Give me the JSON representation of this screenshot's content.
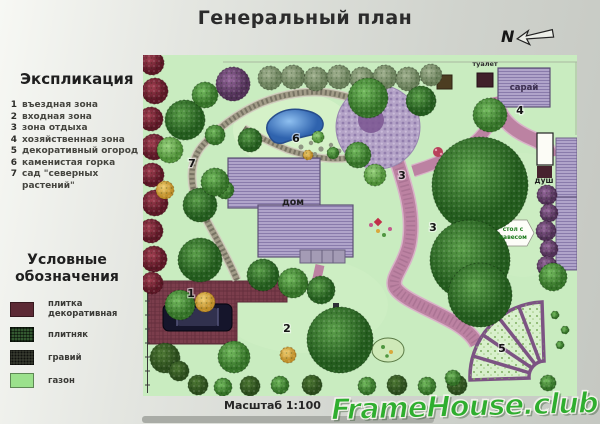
{
  "title": "Генеральный план",
  "compass": {
    "label": "N"
  },
  "explication": {
    "heading": "Экспликация",
    "items": [
      {
        "num": "1",
        "label": "въездная зона"
      },
      {
        "num": "2",
        "label": "входная зона"
      },
      {
        "num": "3",
        "label": "зона отдыха"
      },
      {
        "num": "4",
        "label": "хозяйственная зона"
      },
      {
        "num": "5",
        "label": "декоративный огород"
      },
      {
        "num": "6",
        "label": "каменистая горка"
      },
      {
        "num": "7",
        "label": "сад \"северных растений\""
      }
    ]
  },
  "legend": {
    "heading": "Условные обозначения",
    "items": [
      {
        "label": "плитка декоративная",
        "color": "#5d2a35"
      },
      {
        "label": "плитняк",
        "color": "#335830"
      },
      {
        "label": "гравий",
        "color": "#3c4034"
      },
      {
        "label": "газон",
        "color": "#9be18c"
      }
    ]
  },
  "plan": {
    "labels": {
      "house": "дом",
      "shed": "сарай",
      "toilet": "туалет",
      "shower": "душ",
      "table_line1": "стол с",
      "table_line2": "навесом"
    },
    "markers": [
      "1",
      "2",
      "3",
      "3",
      "4",
      "5",
      "6",
      "7"
    ]
  },
  "scale_label": "Масштаб 1:100",
  "watermark": "FrameHouse.club",
  "colors": {
    "lawn": "#c9ecc0",
    "pond": "#3f7cc9",
    "tile_decorative": "#5d2a35",
    "path_pink": "#bc82a2",
    "gravel": "#a09a86",
    "building_hatch": "#aa9ec6",
    "watermark_green": "#2fae2f"
  }
}
